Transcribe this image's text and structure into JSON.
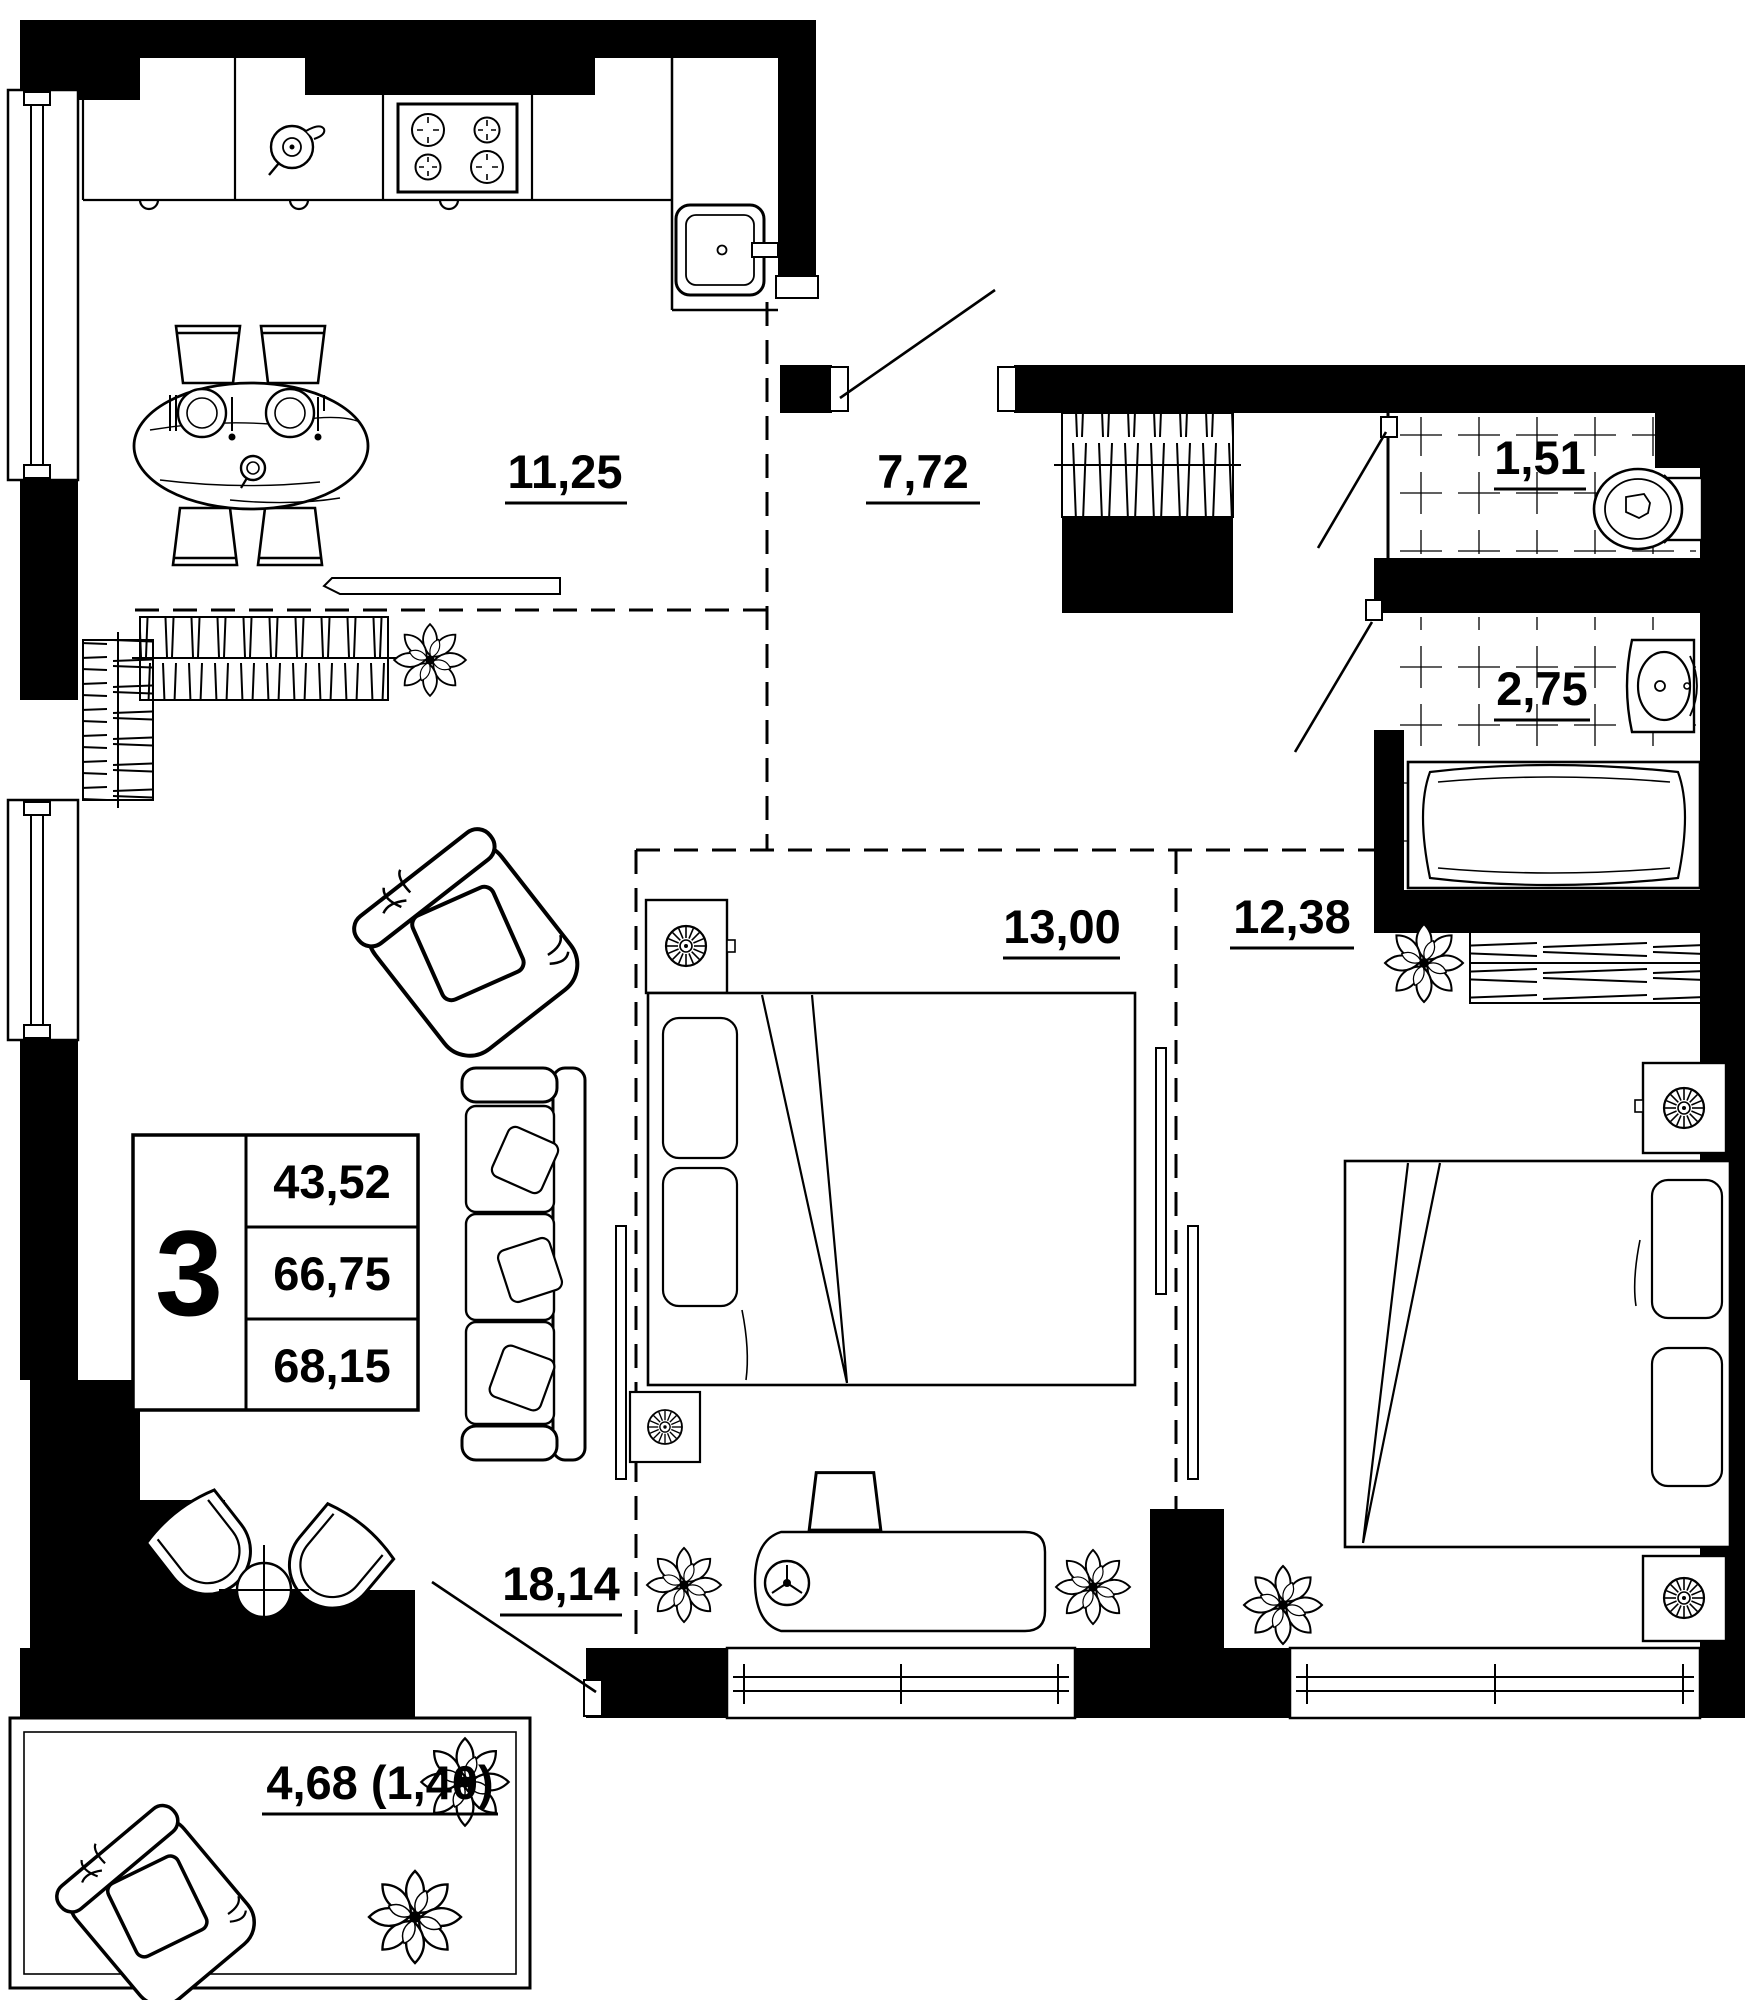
{
  "unit_summary": {
    "rooms_count": "3",
    "values": [
      "43,52",
      "66,75",
      "68,15"
    ]
  },
  "room_areas": {
    "kitchen": "11,25",
    "hallway": "7,72",
    "toilet": "1,51",
    "bathroom": "2,75",
    "bedroom_1": "13,00",
    "bedroom_2": "12,38",
    "living_room": "18,14",
    "balcony": "4,68 (1,40)"
  },
  "colors": {
    "walls": "#000000",
    "background": "#ffffff",
    "lines": "#000000"
  }
}
